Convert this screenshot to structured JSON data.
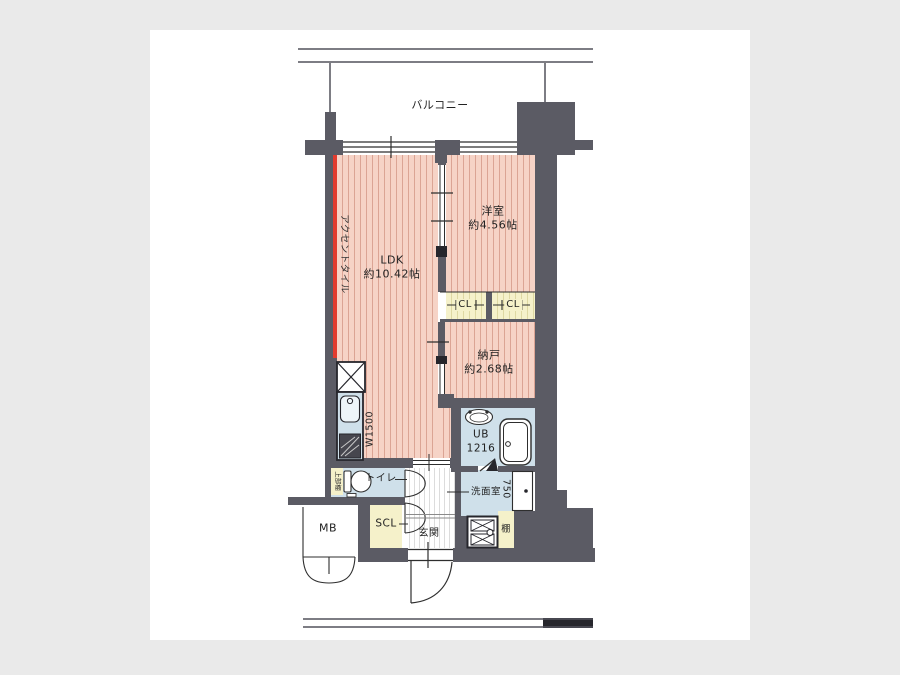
{
  "colors": {
    "canvas_bg": "#eaeaea",
    "paper": "#ffffff",
    "wall": "#5b5b64",
    "pink": "#f6d3c6",
    "cream": "#f5f1ca",
    "blue": "#cfe0ea",
    "red": "#e23b2e"
  },
  "balcony": {
    "label": "バルコニー"
  },
  "rooms": {
    "ldk": {
      "name": "LDK",
      "size": "約10.42帖"
    },
    "western_room": {
      "name": "洋室",
      "size": "約4.56帖"
    },
    "storage_room": {
      "name": "納戸",
      "size": "約2.68帖"
    },
    "unit_bath": {
      "name": "UB",
      "size": "1216"
    },
    "toilet": {
      "name": "トイレ"
    },
    "washroom": {
      "name": "洗面室"
    },
    "entrance": {
      "name": "玄関"
    },
    "shoe_closet": {
      "name": "SCL"
    },
    "meter_box": {
      "name": "MB"
    },
    "shelf": {
      "name": "棚"
    },
    "upper_shelf": {
      "name": "上部棚"
    }
  },
  "closets": [
    "CL",
    "CL"
  ],
  "annotations": {
    "accent_tile": "アクセントタイル",
    "kitchen_width": "W1500",
    "washroom_depth": "750"
  }
}
